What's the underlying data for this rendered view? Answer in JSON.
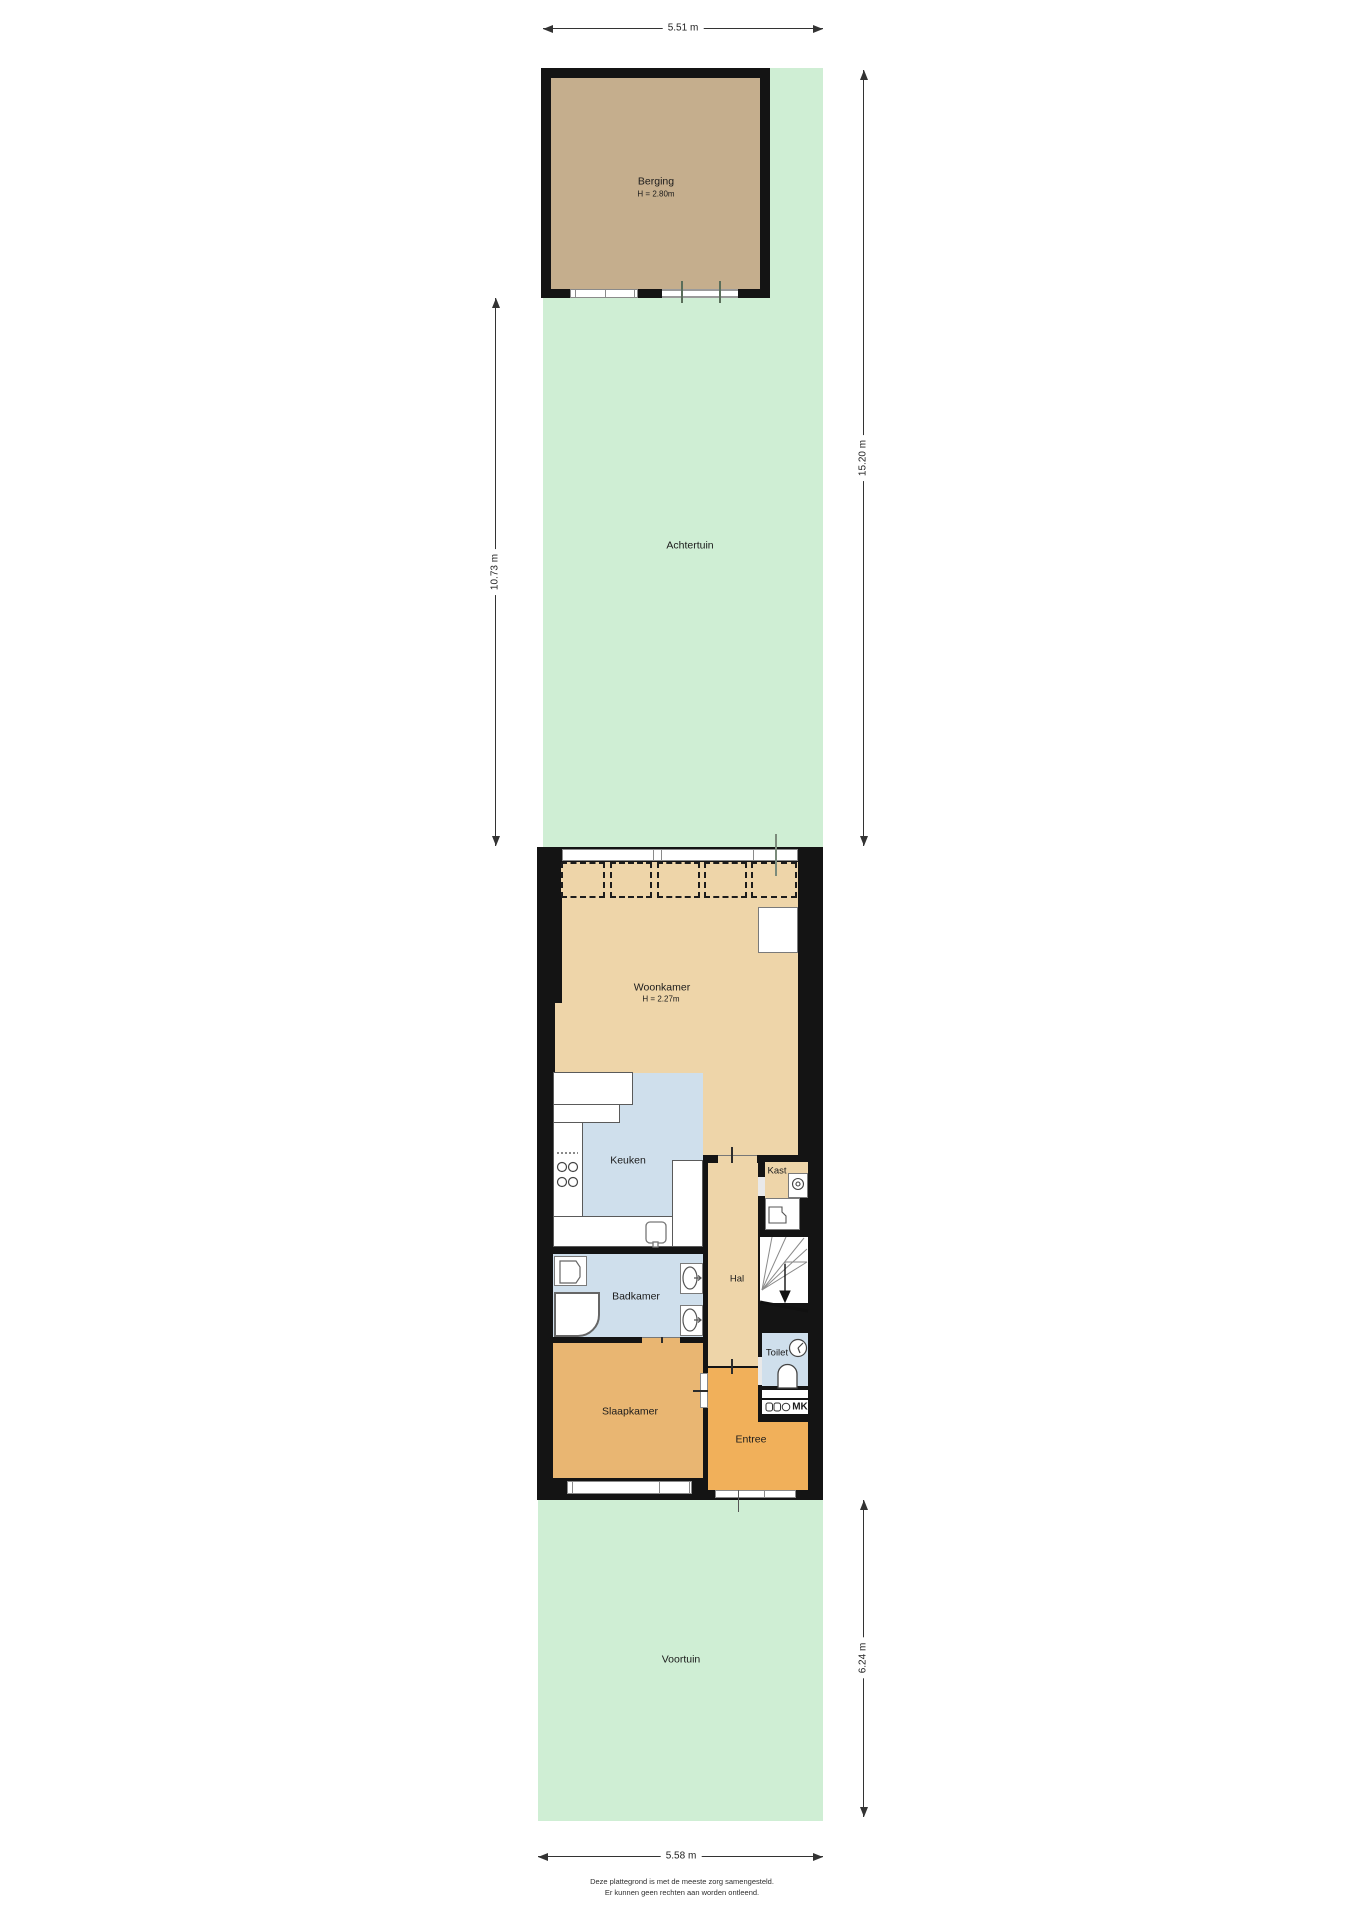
{
  "site": {
    "berging": {
      "label": "Berging",
      "height": "H = 2.80m"
    },
    "achtertuin_label": "Achtertuin",
    "voortuin_label": "Voortuin"
  },
  "rooms": {
    "woonkamer": {
      "label": "Woonkamer",
      "height": "H = 2.27m"
    },
    "keuken_label": "Keuken",
    "kast_label": "Kast",
    "hal_label": "Hal",
    "badkamer_label": "Badkamer",
    "toilet_label": "Toilet",
    "slaapkamer_label": "Slaapkamer",
    "entree_label": "Entree",
    "meterkast_label": "MK"
  },
  "dimensions": {
    "top": "5.51 m",
    "left": "10.73 m",
    "right_upper": "15.20 m",
    "right_lower": "6.24 m",
    "bottom": "5.58 m"
  },
  "footer": {
    "line1": "Deze plattegrond is met de meeste zorg samengesteld.",
    "line2": "Er kunnen geen rechten aan worden ontleend."
  },
  "colors": {
    "green": "#cfeed4",
    "berging": "#c5ae8d",
    "tan": "#eed5a9",
    "blue": "#cfdfec",
    "slaap": "#e9b672",
    "entree": "#f1b05a",
    "wall": "#141414",
    "frame": "#8a8a8a",
    "dim": "#333333"
  }
}
